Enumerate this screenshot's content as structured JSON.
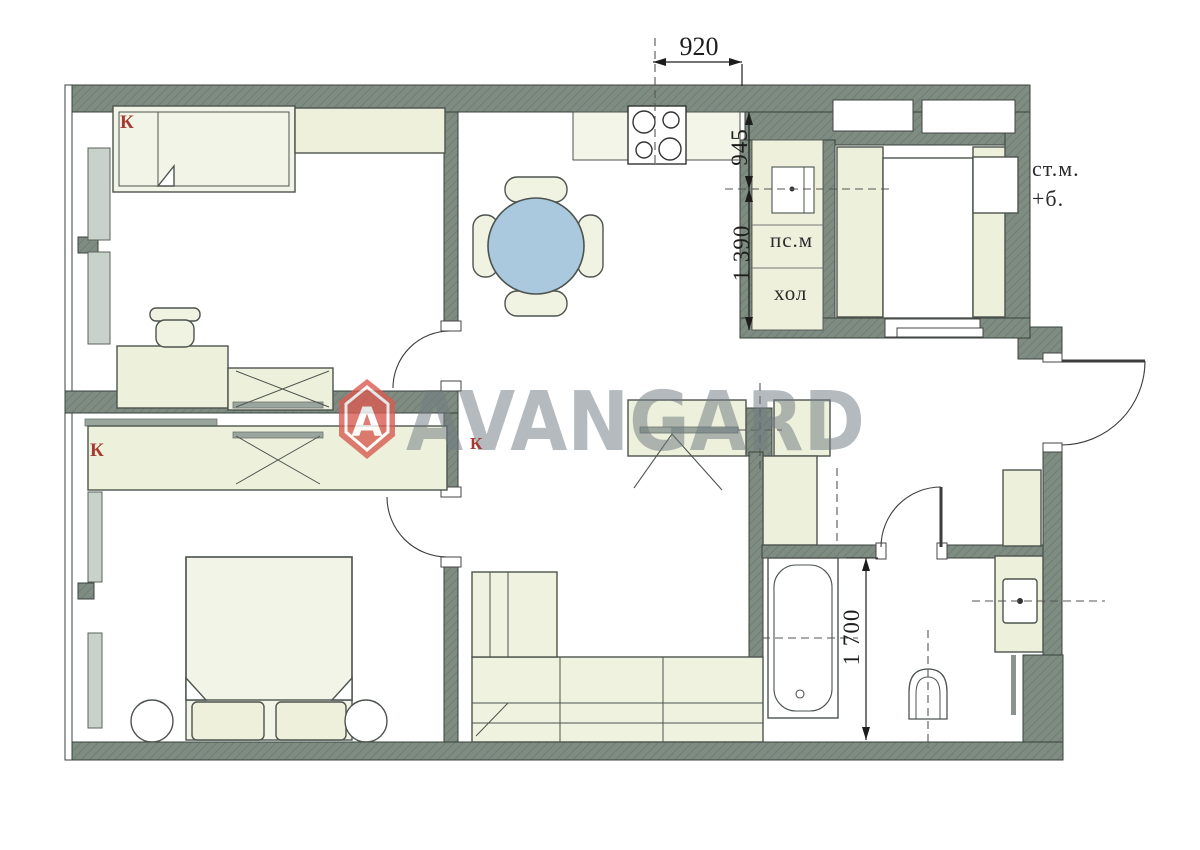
{
  "plan": {
    "brand": {
      "name": "AVANGARD",
      "logo_letter": "A"
    },
    "room_labels": {
      "closet_bed1": "К",
      "closet_bed2": "К",
      "closet_hall": "К",
      "dishwasher": "пс.м",
      "fridge": "хол",
      "washer": "ст.м.",
      "balcony": "+б."
    },
    "dimensions": {
      "kitchen_width": "920",
      "niche_upper": "945",
      "niche_lower": "1 390",
      "bathroom_length": "1 700"
    },
    "colors": {
      "wall": "#7e8c82",
      "wall_hatch": "#6f7d74",
      "furniture": "#edf0db",
      "counter": "#f3f5e9",
      "table_top": "#aac9de",
      "window_sill": "#c9d2ca",
      "label_red": "#a43a30",
      "watermark_gray": "#707a80",
      "logo_red": "#d95c52"
    }
  }
}
